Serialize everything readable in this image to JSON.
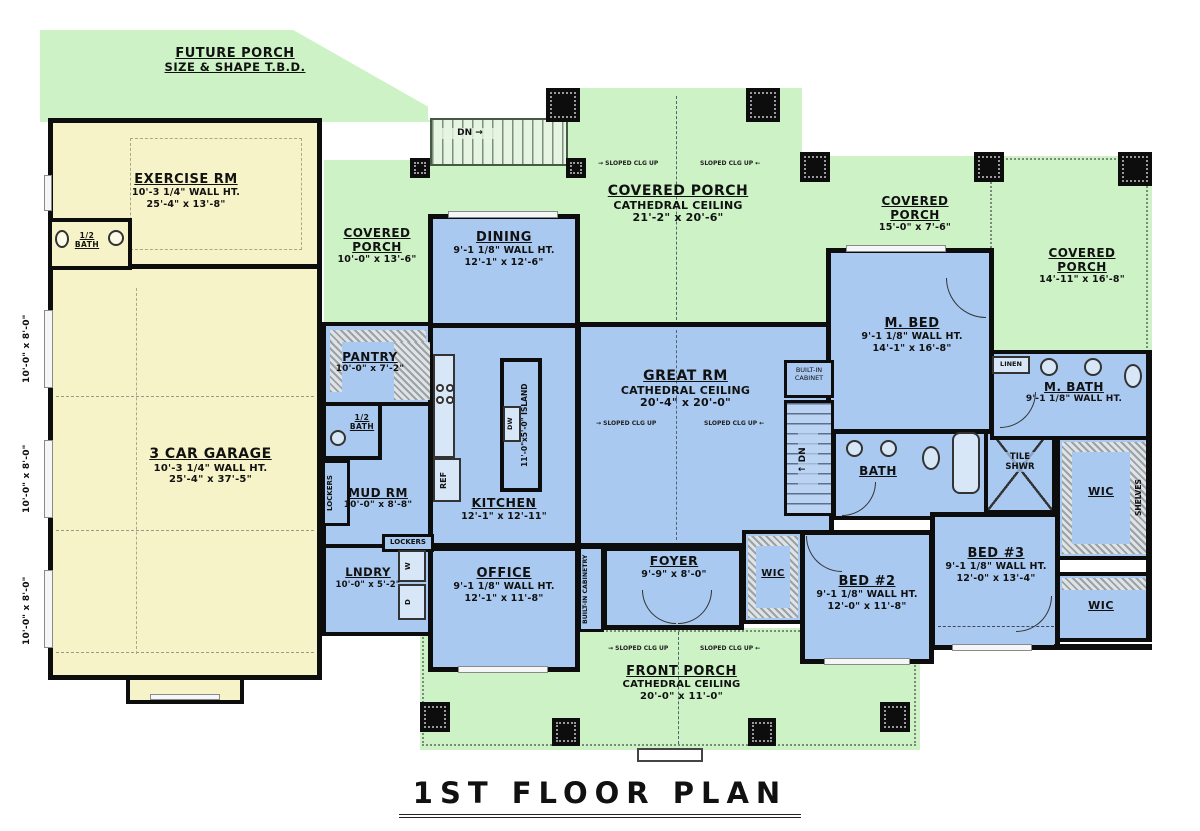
{
  "title": "1ST FLOOR PLAN",
  "colors": {
    "porch_green": "#cdf2c6",
    "garage_yellow": "#f7f3c8",
    "room_blue": "#a9c9f0",
    "wall": "#0d0d0d"
  },
  "labels": {
    "covered": "COVERED",
    "porch": "PORCH",
    "covered_porch": "COVERED PORCH",
    "cathedral": "CATHEDRAL CEILING",
    "wic": "WIC",
    "dn": "DN",
    "dn_arrow": "DN →",
    "ref": "REF",
    "lockers": "LOCKERS",
    "linen": "LINEN",
    "shelves": "SHELVES",
    "tile": "TILE",
    "shwr": "SHWR",
    "bath": "BATH",
    "half_bath": "1/2 BATH",
    "washer": "W",
    "dryer": "D",
    "built_in": "BUILT-IN",
    "cabinet": "CABINET",
    "cabinetry": "CABINETRY",
    "built_in_cabinetry": "BUILT-IN CABINETRY",
    "sloped": "SLOPED CLG UP",
    "garage_door_size": "10'-0\" x 8'-0\"",
    "island": "11'-0\"x5'-0\" ISLAND",
    "dw": "DW"
  },
  "rooms": {
    "future_porch": {
      "name": "FUTURE PORCH",
      "note": "SIZE & SHAPE T.B.D."
    },
    "exercise": {
      "name": "EXERCISE RM",
      "wall": "10'-3 1/4\" WALL HT.",
      "size": "25'-4\" x 13'-8\""
    },
    "garage": {
      "name": "3 CAR GARAGE",
      "wall": "10'-3 1/4\" WALL HT.",
      "size": "25'-4\" x 37'-5\""
    },
    "cov_porch_left": {
      "size": "10'-0\" x 13'-6\""
    },
    "cov_porch_center": {
      "size": "21'-2\" x 20'-6\""
    },
    "cov_porch_mid": {
      "size": "15'-0\" x 7'-6\""
    },
    "cov_porch_right": {
      "size": "14'-11\" x 16'-8\""
    },
    "dining": {
      "name": "DINING",
      "wall": "9'-1 1/8\" WALL HT.",
      "size": "12'-1\" x 12'-6\""
    },
    "great_rm": {
      "name": "GREAT RM",
      "size": "20'-4\" x 20'-0\""
    },
    "m_bed": {
      "name": "M. BED",
      "wall": "9'-1 1/8\" WALL HT.",
      "size": "14'-1\" x 16'-8\""
    },
    "m_bath": {
      "name": "M. BATH",
      "wall": "9'-1 1/8\" WALL HT."
    },
    "pantry": {
      "name": "PANTRY",
      "size": "10'-0\" x 7'-2\""
    },
    "mud_rm": {
      "name": "MUD RM",
      "size": "10'-0\" x 8'-8\""
    },
    "kitchen": {
      "name": "KITCHEN",
      "size": "12'-1\" x 12'-11\""
    },
    "lndry": {
      "name": "LNDRY",
      "size": "10'-0\" x 5'-2\""
    },
    "office": {
      "name": "OFFICE",
      "wall": "9'-1 1/8\" WALL HT.",
      "size": "12'-1\" x 11'-8\""
    },
    "foyer": {
      "name": "FOYER",
      "size": "9'-9\" x 8'-0\""
    },
    "bed2": {
      "name": "BED #2",
      "wall": "9'-1 1/8\" WALL HT.",
      "size": "12'-0\" x 11'-8\""
    },
    "bed3": {
      "name": "BED #3",
      "wall": "9'-1 1/8\" WALL HT.",
      "size": "12'-0\" x 13'-4\""
    },
    "front_porch": {
      "name": "FRONT PORCH",
      "size": "20'-0\" x 11'-0\""
    }
  }
}
